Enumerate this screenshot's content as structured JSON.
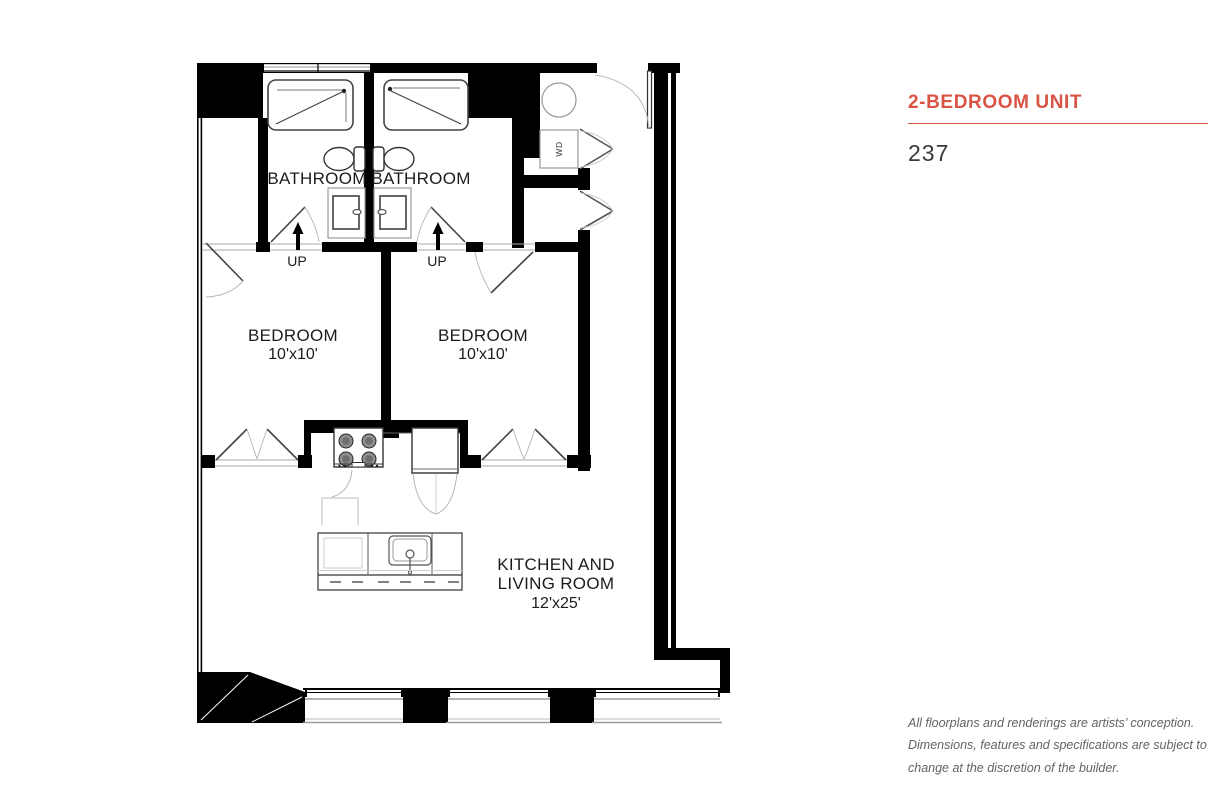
{
  "panel": {
    "title": "2-BEDROOM UNIT",
    "unit_number": "237",
    "disclaimer": "All floorplans and renderings are artists’ conception. Dimensions, features and specifications are subject to change at the discretion of the builder."
  },
  "colors": {
    "accent": "#d95445",
    "wall": "#000000",
    "text_dark": "#3a3a3a",
    "text_muted": "#636363"
  },
  "plan": {
    "bathroom_left": {
      "label": "BATHROOM"
    },
    "bathroom_right": {
      "label": "BATHROOM"
    },
    "bedroom_left": {
      "label": "BEDROOM",
      "dims": "10'x10'"
    },
    "bedroom_right": {
      "label": "BEDROOM",
      "dims": "10'x10'"
    },
    "living": {
      "line1": "KITCHEN AND",
      "line2": "LIVING ROOM",
      "dims": "12'x25'"
    },
    "stair_left": {
      "label": "UP"
    },
    "stair_right": {
      "label": "UP"
    },
    "laundry": {
      "label": "WD"
    }
  }
}
